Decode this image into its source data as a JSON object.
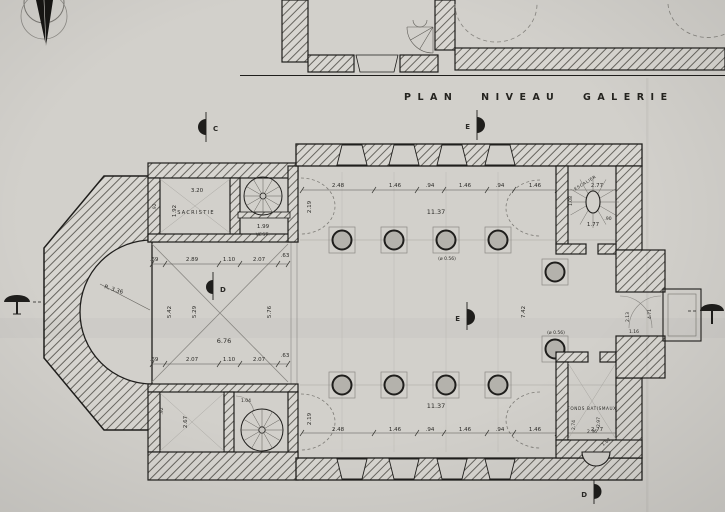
{
  "title": "PLAN NIVEAU GALERIE",
  "rooms": {
    "sacristie": "SACRISTIE",
    "vestiaire": "VEST.",
    "fonts_baptismaux": "FONDS BATISMAUX",
    "escalier": "ESCALIER"
  },
  "markers": {
    "c": "C",
    "e_top": "E",
    "d_mid": "D",
    "e_mid": "E",
    "d_bottom": "D"
  },
  "dims": {
    "nave_top_chain": [
      "2.48",
      "1.46",
      ".94",
      "1.46",
      ".94",
      "1.46",
      "2.77"
    ],
    "nave_bottom_chain": [
      "2.48",
      "1.46",
      ".94",
      "1.46",
      ".94",
      "1.46",
      "2.77"
    ],
    "nave_length_top": "11.37",
    "nave_length_bottom": "11.37",
    "crossing_top_chain": [
      ".69",
      "2.89",
      "1.10",
      "2.07",
      ".63"
    ],
    "crossing_bottom_chain": [
      ".69",
      "2.07",
      "1.10",
      "2.07",
      ".63"
    ],
    "crossing_width": "6.76",
    "crossing_v": [
      "5.42",
      "5.29",
      "5.76"
    ],
    "apse_radius": "R. 3.36",
    "nave_mid_height": "7.42",
    "bay_top": "2.19",
    "bay_bottom": "2.19",
    "col_dia_nave": "(ø 0.56)",
    "col_dia_chancel": "(ø 0.56)",
    "sacristie_w": "3.20",
    "sacristie_d": "1.92",
    "sacristie_s": ".92",
    "vest_w": "1.99",
    "stair_w": "1.77",
    "stair_d": "1.08",
    "stair_s": ".90",
    "fonts_d1": "2.74",
    "fonts_d2": "2.97",
    "fonts_d3": "2.36",
    "fonts_d4": "1.62",
    "sw_room_d1": "2.67",
    "sw_room_d2": ".92",
    "sw_door": "1.04",
    "entry_d1": "2.13",
    "entry_d2": "4.71",
    "entry_d3": "1.16"
  },
  "colors": {
    "paper": "#d2d0cb",
    "ink": "#1f1e1c",
    "light_line": "#98968f",
    "hatch_line": "#67655f",
    "column_fill": "#b4b2ac"
  }
}
